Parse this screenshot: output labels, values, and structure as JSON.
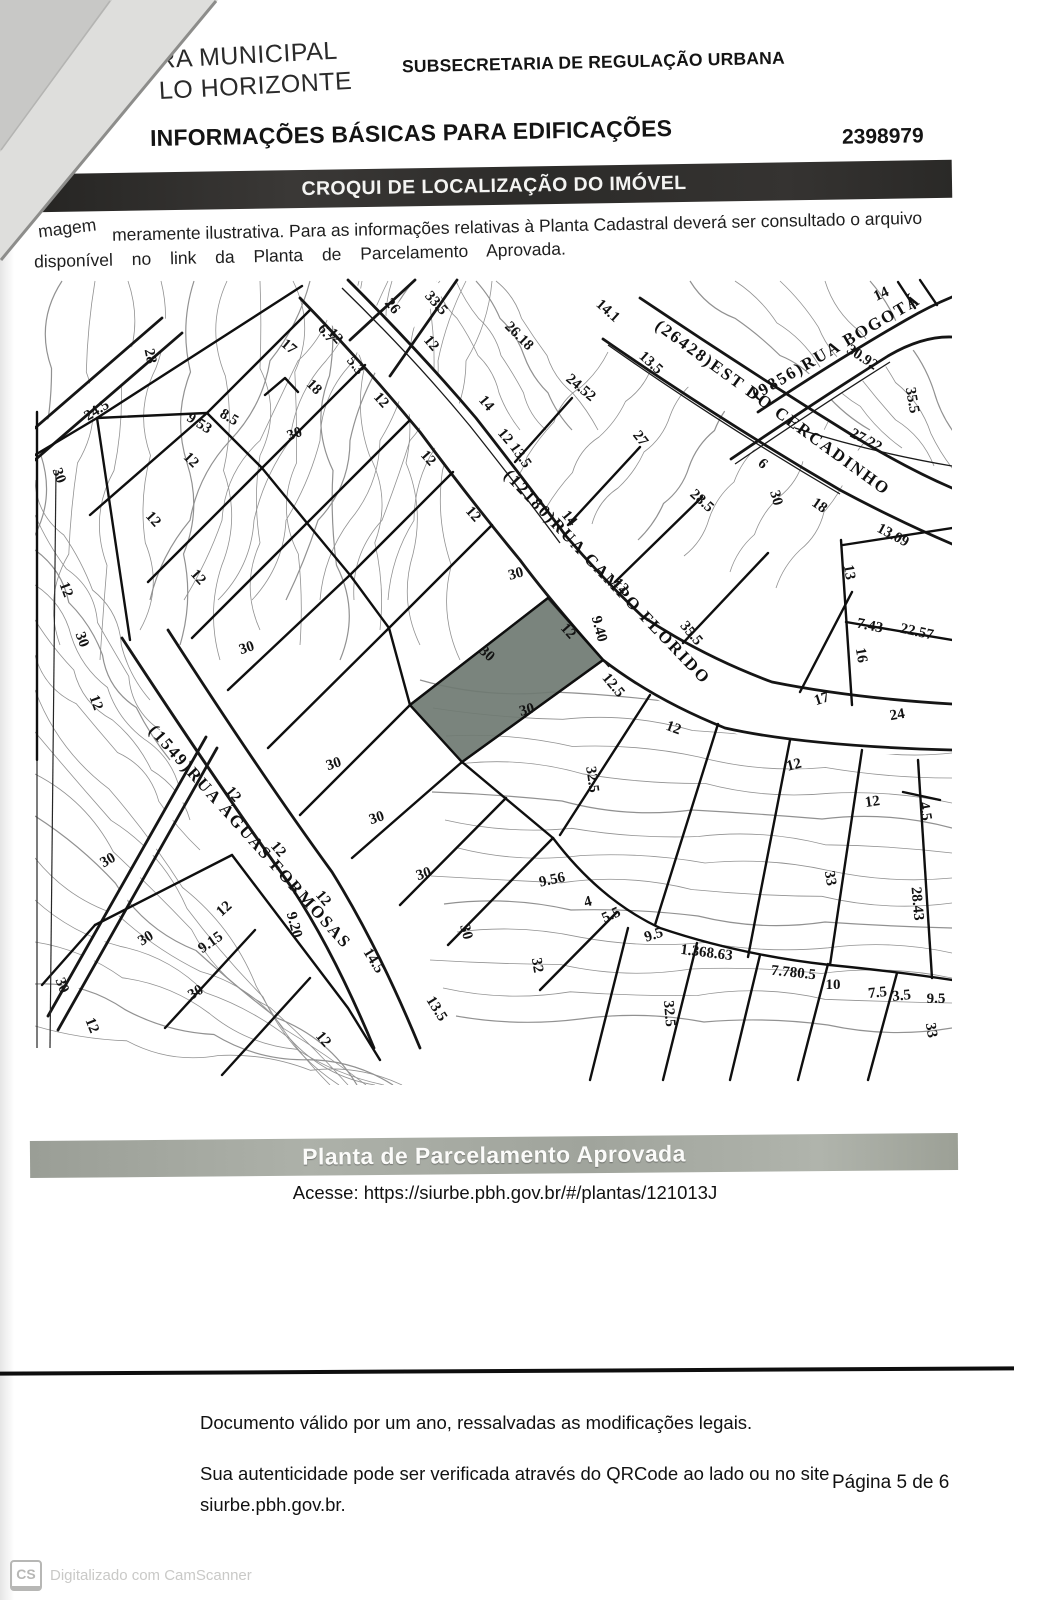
{
  "header": {
    "logo1": "RA MUNICIPAL",
    "logo2": "LO HORIZONTE",
    "department": "SUBSECRETARIA DE REGULAÇÃO URBANA",
    "title": "INFORMAÇÕES BÁSICAS PARA EDIFICAÇÕES",
    "doc_number": "2398979",
    "section_bar": "CROQUI DE LOCALIZAÇÃO DO IMÓVEL"
  },
  "note": {
    "lead1": "magem",
    "rest1": "meramente ilustrativa.   Para as informações relativas à Planta Cadastral deverá ser consultado o arquivo",
    "line2": "disponível no link da Planta de Parcelamento Aprovada."
  },
  "map": {
    "streets": [
      {
        "name": "(12180)RUA CAMPO FLORIDO",
        "path": "M503,476 L712,694",
        "fs": 17,
        "ls": 2
      },
      {
        "name": "(26428)EST DO CERCADINHO",
        "path": "M654,328 L910,514",
        "fs": 17,
        "ls": 2.5
      },
      {
        "name": "(9856)RUA BOGOTÁ",
        "path": "M756,400 L930,298",
        "fs": 16,
        "ls": 1.5
      },
      {
        "name": "(1549)RUA ÁGUAS FORMOSAS",
        "path": "M148,731 L357,964",
        "fs": 16,
        "ls": 1.5
      }
    ],
    "lots": [
      {
        "l": "L. 003",
        "q": "Q. 080",
        "x": 205,
        "y": 335,
        "r": -8
      },
      {
        "l": "L. 004A",
        "q": "Q. 080",
        "x": 284,
        "y": 366,
        "r": -12
      },
      {
        "l": "L. 004B",
        "q": "Q. 080",
        "x": 259,
        "y": 422,
        "r": -8
      },
      {
        "l": "L. 005",
        "q": "Q. 080",
        "x": 313,
        "y": 456,
        "r": -8
      },
      {
        "l": "L. 006",
        "q": "Q. 080",
        "x": 354,
        "y": 506,
        "r": -8
      },
      {
        "l": "L. 007",
        "q": "Q. 080",
        "x": 396,
        "y": 566,
        "r": -8
      },
      {
        "l": "L. 008",
        "q": "Q. 080",
        "x": 438,
        "y": 605,
        "r": -8
      },
      {
        "l": "L. 009",
        "q": "Q. 080",
        "x": 504,
        "y": 666,
        "r": -14,
        "hl": true
      },
      {
        "l": "L. 010",
        "q": "Q. 080",
        "x": 549,
        "y": 750,
        "r": -8
      },
      {
        "l": "L. 011",
        "q": "Q. 080",
        "x": 616,
        "y": 806,
        "r": -8,
        "fade": true
      },
      {
        "l": "L. 012",
        "q": "Q. 080",
        "x": 691,
        "y": 851,
        "r": -8
      },
      {
        "l": "L. 013",
        "q": "Q. 080",
        "x": 772,
        "y": 882,
        "r": -8
      },
      {
        "l": "L. 014",
        "q": "Q. 080",
        "x": 861,
        "y": 899,
        "r": -8
      },
      {
        "l": "L. 036",
        "q": "Q. 080",
        "x": 116,
        "y": 502,
        "r": -8
      },
      {
        "l": "L. 035",
        "q": "Q. 080",
        "x": 160,
        "y": 568,
        "r": -8
      },
      {
        "l": "L. 034",
        "q": "Q. 080",
        "x": 215,
        "y": 623,
        "r": -8
      },
      {
        "l": "L. 033",
        "q": "Q. 080",
        "x": 266,
        "y": 683,
        "r": -8
      },
      {
        "l": "L. 032",
        "q": "Q. 080",
        "x": 301,
        "y": 738,
        "r": -8
      },
      {
        "l": "L. 031",
        "q": "Q. 080",
        "x": 348,
        "y": 793,
        "r": -8,
        "fade": true
      },
      {
        "l": "L. 030",
        "q": "Q. 080",
        "x": 393,
        "y": 846,
        "r": -8
      },
      {
        "l": "L. 029",
        "q": "Q. 080",
        "x": 439,
        "y": 898,
        "r": -8
      },
      {
        "l": "L. 028",
        "q": "Q. 080",
        "x": 498,
        "y": 948,
        "r": -8
      },
      {
        "l": "L. 027",
        "q": "Q. 080",
        "x": 554,
        "y": 984,
        "r": -8
      },
      {
        "l": "L. 026",
        "q": "Q. 080",
        "x": 619,
        "y": 1000,
        "r": -8
      },
      {
        "l": "L. 025",
        "q": "Q. 080",
        "x": 689,
        "y": 1009,
        "r": -8
      },
      {
        "l": "L. 024",
        "q": "Q. 080",
        "x": 749,
        "y": 1017,
        "r": -8
      },
      {
        "l": "L. 023",
        "q": "Q. 080",
        "x": 819,
        "y": 1023,
        "r": -8
      },
      {
        "l": "L. 022",
        "q": "Q. 080",
        "x": 887,
        "y": 1029,
        "r": -8
      },
      {
        "l": "L. 001",
        "q": "Q. 078",
        "x": 169,
        "y": 963,
        "r": -8
      },
      {
        "l": "L. 002",
        "q": "Q. 078",
        "x": 221,
        "y": 1013,
        "r": -8
      },
      {
        "l": "L. 003",
        "q": "Q. 078",
        "x": 286,
        "y": 1036,
        "r": -8
      },
      {
        "l": "L. 002",
        "q": "Q. 081",
        "x": 474,
        "y": 316,
        "r": -8
      },
      {
        "l": "L. 003A",
        "q": "Q. 081",
        "x": 541,
        "y": 355,
        "r": -8
      },
      {
        "l": "L. 004",
        "q": "Q. 081",
        "x": 604,
        "y": 410,
        "r": -8
      },
      {
        "l": "L. 005",
        "q": "Q. 081",
        "x": 661,
        "y": 470,
        "r": -8
      },
      {
        "l": "L. 006",
        "q": "Q. 081",
        "x": 726,
        "y": 565,
        "r": -8
      },
      {
        "l": "L. 007",
        "q": "Q. 081",
        "x": 823,
        "y": 594,
        "r": -8
      },
      {
        "l": "L. 008B",
        "q": "Q. 081",
        "x": 889,
        "y": 566,
        "r": -8
      },
      {
        "l": "L. 009",
        "q": "Q. 081",
        "x": 894,
        "y": 653,
        "r": -8
      },
      {
        "l": "L. 026",
        "q": "Q. 022",
        "x": 894,
        "y": 391,
        "r": -8
      }
    ],
    "dims": [
      [
        "28",
        146,
        357,
        78
      ],
      [
        "24.5",
        99,
        414,
        -32
      ],
      [
        "17",
        286,
        350,
        40
      ],
      [
        "6.7",
        323,
        336,
        52
      ],
      [
        "5.3",
        352,
        368,
        52
      ],
      [
        "18",
        311,
        390,
        45
      ],
      [
        "9.53",
        197,
        427,
        32
      ],
      [
        "8.5",
        227,
        421,
        30
      ],
      [
        "12",
        188,
        463,
        45
      ],
      [
        "30",
        296,
        438,
        -20
      ],
      [
        "12",
        378,
        403,
        48
      ],
      [
        "26",
        389,
        309,
        50
      ],
      [
        "33.5",
        433,
        306,
        48
      ],
      [
        "12",
        428,
        346,
        50
      ],
      [
        "26.18",
        516,
        339,
        45
      ],
      [
        "14",
        483,
        406,
        50
      ],
      [
        "14.1",
        605,
        314,
        42
      ],
      [
        "13.5",
        648,
        366,
        42
      ],
      [
        "24.52",
        578,
        391,
        40
      ],
      [
        "27",
        637,
        441,
        52
      ],
      [
        "13.5",
        517,
        458,
        55
      ],
      [
        "14",
        566,
        521,
        50
      ],
      [
        "28.5",
        699,
        504,
        42
      ],
      [
        "6",
        760,
        467,
        40
      ],
      [
        "30",
        772,
        499,
        75
      ],
      [
        "18",
        817,
        509,
        35
      ],
      [
        "30.92",
        860,
        361,
        33
      ],
      [
        "27.22",
        864,
        444,
        28
      ],
      [
        "35.5",
        908,
        401,
        80
      ],
      [
        "13.09",
        891,
        539,
        28
      ],
      [
        "13",
        845,
        573,
        80
      ],
      [
        "7.43",
        869,
        630,
        12
      ],
      [
        "22.57",
        916,
        636,
        12
      ],
      [
        "16",
        857,
        656,
        80
      ],
      [
        "35.5",
        688,
        636,
        50
      ],
      [
        "9.40",
        595,
        630,
        75
      ],
      [
        "12",
        565,
        634,
        48
      ],
      [
        "30",
        484,
        657,
        42
      ],
      [
        "12.5",
        610,
        688,
        50
      ],
      [
        "12",
        672,
        732,
        20
      ],
      [
        "17",
        823,
        703,
        -18
      ],
      [
        "24",
        898,
        719,
        -10
      ],
      [
        "12",
        795,
        769,
        -14
      ],
      [
        "12",
        873,
        806,
        -8
      ],
      [
        "4.5",
        921,
        812,
        80
      ],
      [
        "33",
        826,
        879,
        80
      ],
      [
        "28.43",
        913,
        904,
        85
      ],
      [
        "32.5",
        588,
        780,
        82
      ],
      [
        "9.56",
        553,
        884,
        -12
      ],
      [
        "4",
        589,
        906,
        -15
      ],
      [
        "5.5",
        613,
        919,
        -25
      ],
      [
        "9.5",
        655,
        939,
        -18
      ],
      [
        "1.368.63",
        706,
        957,
        7
      ],
      [
        "7.780.5",
        793,
        977,
        6
      ],
      [
        "10",
        833,
        989,
        0
      ],
      [
        "7.5",
        878,
        997,
        -6
      ],
      [
        "3.5",
        902,
        1000,
        -6
      ],
      [
        "9.5",
        936,
        1003,
        0
      ],
      [
        "33",
        927,
        1031,
        80
      ],
      [
        "32",
        533,
        966,
        80
      ],
      [
        "32.5",
        665,
        1014,
        85
      ],
      [
        "13.5",
        433,
        1011,
        58
      ],
      [
        "14.5",
        370,
        963,
        58
      ],
      [
        "9.15",
        213,
        946,
        -35
      ],
      [
        "9.20",
        290,
        926,
        75
      ],
      [
        "12",
        230,
        797,
        50
      ],
      [
        "12",
        275,
        852,
        50
      ],
      [
        "12",
        320,
        901,
        50
      ],
      [
        "12",
        227,
        912,
        -42
      ],
      [
        "30",
        110,
        864,
        -30
      ],
      [
        "30",
        148,
        942,
        -32
      ],
      [
        "30",
        198,
        996,
        -32
      ],
      [
        "12",
        320,
        1042,
        50
      ],
      [
        "30",
        58,
        987,
        68
      ],
      [
        "12",
        88,
        1027,
        68
      ],
      [
        "30",
        55,
        477,
        70
      ],
      [
        "12",
        62,
        591,
        70
      ],
      [
        "30",
        78,
        641,
        70
      ],
      [
        "12",
        92,
        704,
        70
      ],
      [
        "12",
        332,
        339,
        48
      ],
      [
        "12",
        425,
        461,
        48
      ],
      [
        "12",
        470,
        517,
        48
      ],
      [
        "12",
        502,
        439,
        50
      ],
      [
        "12",
        618,
        589,
        44
      ],
      [
        "30",
        517,
        578,
        -15
      ],
      [
        "30",
        528,
        714,
        -15
      ],
      [
        "12",
        150,
        522,
        48
      ],
      [
        "12",
        195,
        580,
        48
      ],
      [
        "30",
        248,
        652,
        -18
      ],
      [
        "30",
        335,
        768,
        -18
      ],
      [
        "30",
        378,
        822,
        -18
      ],
      [
        "30",
        425,
        878,
        -18
      ],
      [
        "30",
        462,
        933,
        75
      ],
      [
        "14",
        883,
        298,
        -25
      ]
    ]
  },
  "legend": {
    "items": [
      {
        "icon": "grid",
        "label": "Imóvel tombado"
      },
      {
        "icon": "stripes",
        "label": "Imóvel com processo de tombamento aberto"
      },
      {
        "icon": "solid",
        "label": "Lote consultado"
      }
    ]
  },
  "plate": {
    "title": "Planta de Parcelamento Aprovada",
    "access": "Acesse: https://siurbe.pbh.gov.br/#/plantas/121013J"
  },
  "footer": {
    "validity": "Documento válido por um ano, ressalvadas as modificações legais.",
    "auth_line1": "Sua autenticidade pode ser verificada através do QRCode ao lado ou no site",
    "auth_line2": "siurbe.pbh.gov.br.",
    "page": "Página 5 de 6"
  },
  "scanner": {
    "badge": "CS",
    "text": "Digitalizado com CamScanner"
  },
  "colors": {
    "ink": "#141414",
    "section_bar": "#2f2e2c",
    "plate_bar": "#a3a79f",
    "lot_highlight": "#6f7a72",
    "legend_solid": "#75807a"
  }
}
